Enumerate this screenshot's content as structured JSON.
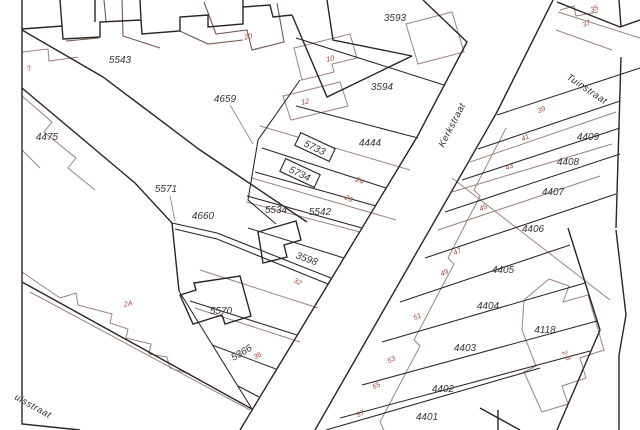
{
  "map": {
    "type": "cadastral-parcel-map",
    "background": "#ffffff",
    "colors": {
      "parcel_line": "#2a2424",
      "building_line": "#9c837d",
      "parcel_label": "#3b3535",
      "house_number": "#ae423c"
    },
    "streets": [
      {
        "name": "Kerkstraat"
      },
      {
        "name": "Tuinstraat"
      },
      {
        "name": "uisstraat"
      }
    ],
    "parcel_labels": [
      {
        "text": "5543"
      },
      {
        "text": "4475"
      },
      {
        "text": "4659"
      },
      {
        "text": "5571"
      },
      {
        "text": "4660"
      },
      {
        "text": "5534"
      },
      {
        "text": "5542"
      },
      {
        "text": "3593"
      },
      {
        "text": "3594"
      },
      {
        "text": "4444"
      },
      {
        "text": "5733"
      },
      {
        "text": "5734"
      },
      {
        "text": "3598"
      },
      {
        "text": "5570"
      },
      {
        "text": "5366"
      },
      {
        "text": "4409"
      },
      {
        "text": "4408"
      },
      {
        "text": "4407"
      },
      {
        "text": "4406"
      },
      {
        "text": "4405"
      },
      {
        "text": "4404"
      },
      {
        "text": "4403"
      },
      {
        "text": "4402"
      },
      {
        "text": "4401"
      },
      {
        "text": "4118"
      }
    ],
    "house_numbers": [
      {
        "text": "7"
      },
      {
        "text": "20"
      },
      {
        "text": "10"
      },
      {
        "text": "12"
      },
      {
        "text": "24"
      },
      {
        "text": "26"
      },
      {
        "text": "32"
      },
      {
        "text": "2A"
      },
      {
        "text": "36"
      },
      {
        "text": "35"
      },
      {
        "text": "37"
      },
      {
        "text": "39"
      },
      {
        "text": "41"
      },
      {
        "text": "43"
      },
      {
        "text": "45"
      },
      {
        "text": "47"
      },
      {
        "text": "49"
      },
      {
        "text": "51"
      },
      {
        "text": "53"
      },
      {
        "text": "55"
      },
      {
        "text": "57"
      },
      {
        "text": "2-8"
      }
    ]
  }
}
